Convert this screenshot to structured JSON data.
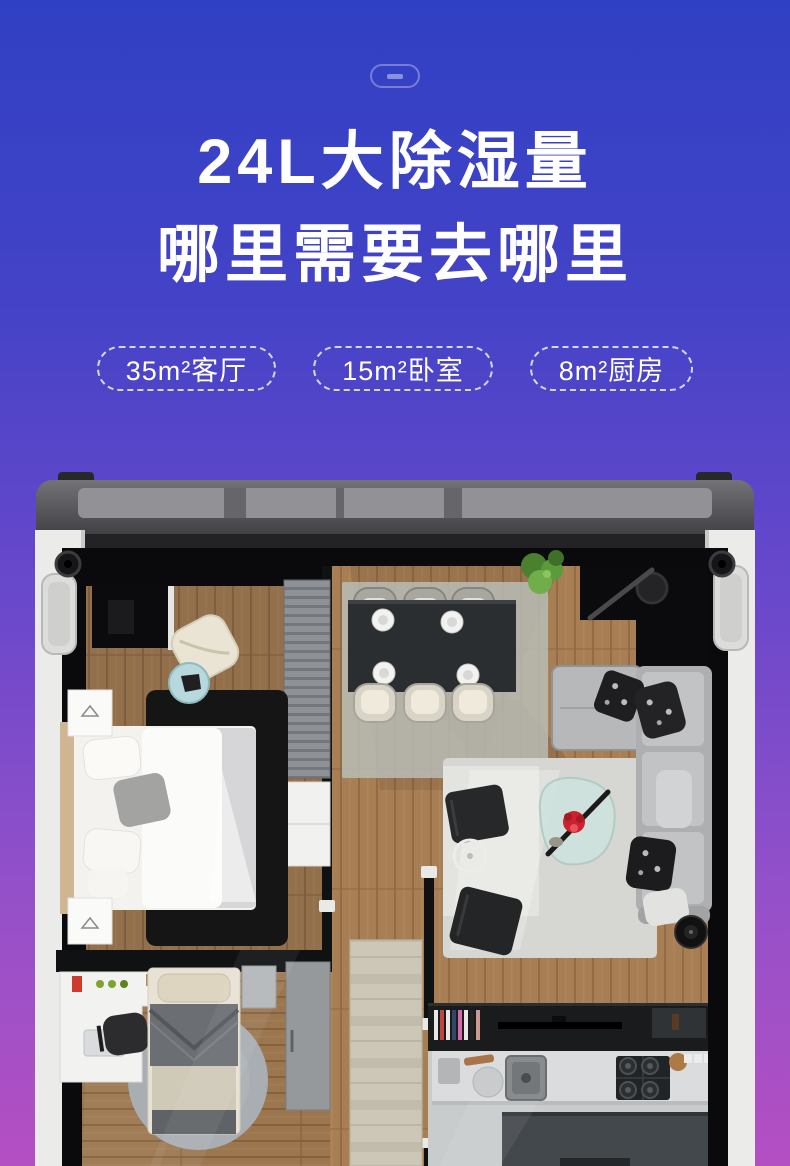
{
  "page": {
    "background_gradient": [
      "#3040c4",
      "#6b48cb",
      "#b44fc3"
    ]
  },
  "hero": {
    "badge_icon": "rounded-dash-icon",
    "title_line1": "24L大除湿量",
    "title_line2": "哪里需要去哪里",
    "room_badges": [
      {
        "label": "35m²客厅"
      },
      {
        "label": "15m²卧室"
      },
      {
        "label": "8m²厨房"
      }
    ]
  },
  "floorplan": {
    "image_type": "top-down 3D apartment render inside dehumidifier shell",
    "palette": {
      "shell_white": "#ebebe9",
      "lid_gray": "#6f6f73",
      "wall_black": "#0b0b0d",
      "wood_floor": "#a87e54",
      "rug_light": "#d6d6d2",
      "rug_black": "#151515",
      "sofa_gray": "#b0b1b3",
      "counter_gray": "#dadcdd",
      "accent_flower_red": "#cc2230",
      "plant_green": "#5d9a3c"
    }
  }
}
